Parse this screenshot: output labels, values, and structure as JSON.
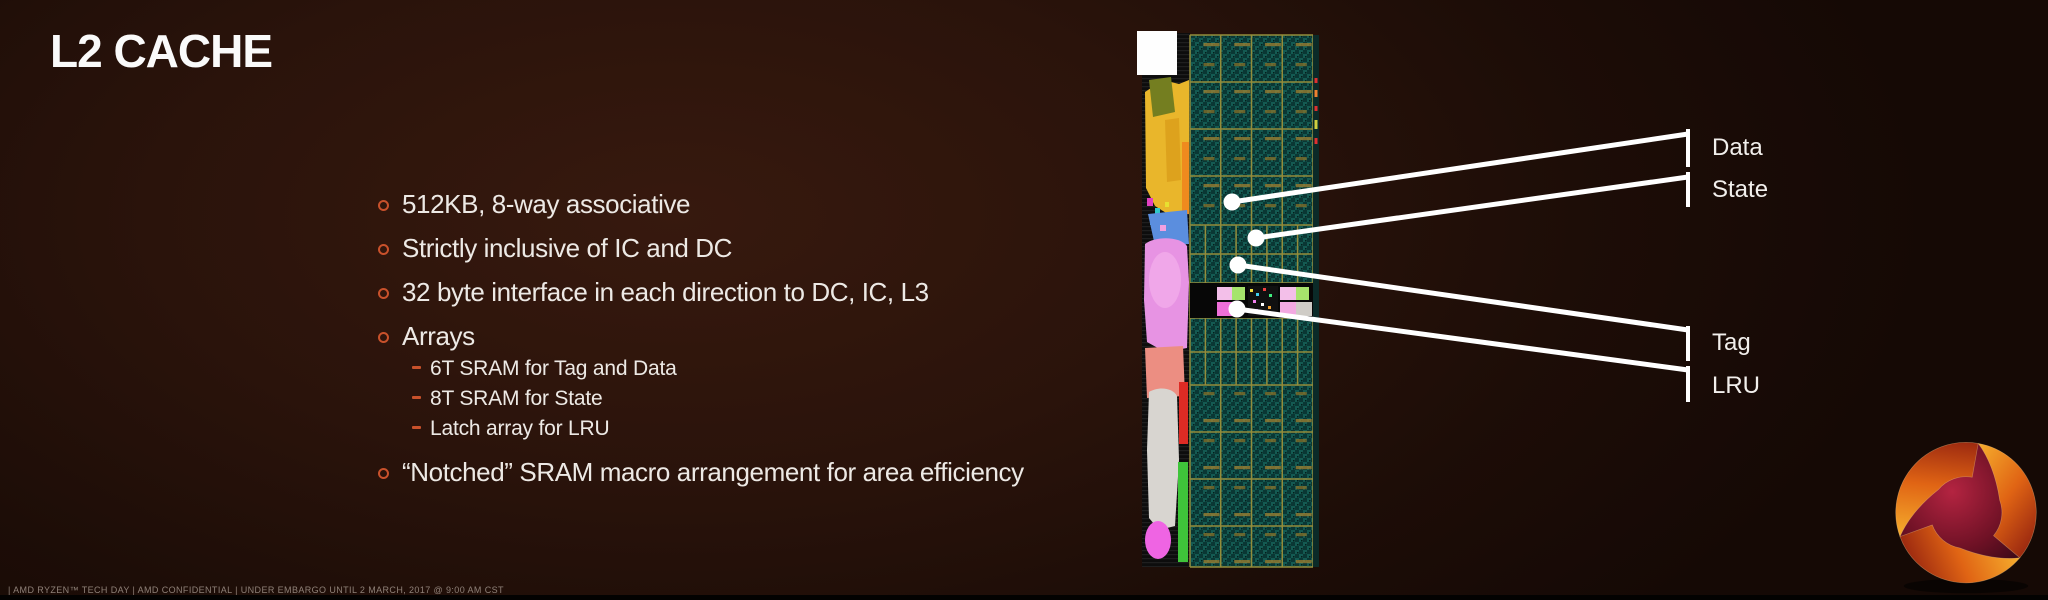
{
  "slide": {
    "title": "L2 CACHE",
    "bullets": [
      {
        "text": "512KB, 8-way associative"
      },
      {
        "text": "Strictly inclusive of IC and DC"
      },
      {
        "text": "32 byte interface in each direction to DC, IC, L3"
      },
      {
        "text": "Arrays",
        "sub": [
          "6T SRAM for Tag and Data",
          "8T SRAM for State",
          "Latch array for LRU"
        ]
      },
      {
        "text": "“Notched” SRAM macro arrangement for area efficiency"
      }
    ],
    "callouts": [
      {
        "label": "Data"
      },
      {
        "label": "State"
      },
      {
        "label": "Tag"
      },
      {
        "label": "LRU"
      }
    ],
    "die_shot": {
      "description": "L2 cache die shot with SRAM macro arrays"
    },
    "footer": "|   AMD RYZEN™ TECH DAY   |   AMD CONFIDENTIAL   |   UNDER EMBARGO UNTIL 2 MARCH, 2017 @ 9:00 AM CST",
    "colors": {
      "background": "#2A130B",
      "accent_bullet": "#C8512B",
      "text": "#EDE9E5",
      "callout": "#FFFFFF"
    }
  }
}
